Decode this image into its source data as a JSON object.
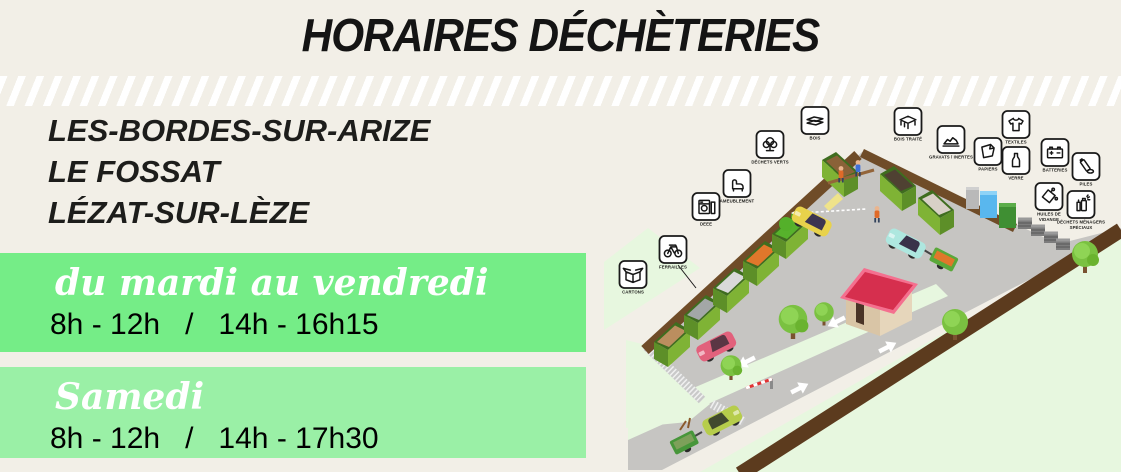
{
  "title": "HORAIRES DÉCHÈTERIES",
  "locations": [
    "LES-BORDES-SUR-ARIZE",
    "LE FOSSAT",
    "LÉZAT-SUR-LÈZE"
  ],
  "schedule": [
    {
      "days": "du mardi au vendredi",
      "hours": "8h - 12h   /   14h - 16h15"
    },
    {
      "days": "Samedi",
      "hours": "8h - 12h   /   14h - 17h30"
    }
  ],
  "colors": {
    "background": "#f2efe7",
    "banner_weekdays": "#75ed87",
    "banner_saturday": "#9af0a6",
    "text_dark": "#1d1d1b",
    "stripe": "#ffffff"
  },
  "facility": {
    "signs": [
      {
        "id": "cartons",
        "icon": "box-icon",
        "lines": [
          "CARTONS"
        ]
      },
      {
        "id": "ferrailles",
        "icon": "bicycle-icon",
        "lines": [
          "FERRAILLES"
        ]
      },
      {
        "id": "deee",
        "icon": "appliance-icon",
        "lines": [
          "DEEE"
        ]
      },
      {
        "id": "ameublement",
        "icon": "armchair-icon",
        "lines": [
          "AMEUBLEMENT"
        ]
      },
      {
        "id": "dechets-verts",
        "icon": "tree-icon",
        "lines": [
          "DÉCHETS VERTS"
        ]
      },
      {
        "id": "bois",
        "icon": "planks-icon",
        "lines": [
          "BOIS"
        ]
      },
      {
        "id": "bois-traite",
        "icon": "table-icon",
        "lines": [
          "BOIS TRAITÉ"
        ]
      },
      {
        "id": "gravats-inertes",
        "icon": "rubble-icon",
        "lines": [
          "GRAVATS / INERTES"
        ]
      },
      {
        "id": "papiers",
        "icon": "paper-icon",
        "lines": [
          "PAPIERS"
        ]
      },
      {
        "id": "textiles",
        "icon": "tshirt-icon",
        "lines": [
          "TEXTILES"
        ]
      },
      {
        "id": "verre",
        "icon": "bottle-icon",
        "lines": [
          "VERRE"
        ]
      },
      {
        "id": "batteries",
        "icon": "car-battery-icon",
        "lines": [
          "BATTERIES"
        ]
      },
      {
        "id": "piles",
        "icon": "battery-cell-icon",
        "lines": [
          "PILES"
        ]
      },
      {
        "id": "huiles-de-vidange",
        "icon": "oil-can-icon",
        "lines": [
          "HUILES DE",
          "VIDANGE"
        ]
      },
      {
        "id": "dechets-menagers-speciaux",
        "icon": "spray-can-icon",
        "lines": [
          "DÉCHETS MÉNAGERS",
          "SPÉCIAUX"
        ]
      }
    ]
  }
}
